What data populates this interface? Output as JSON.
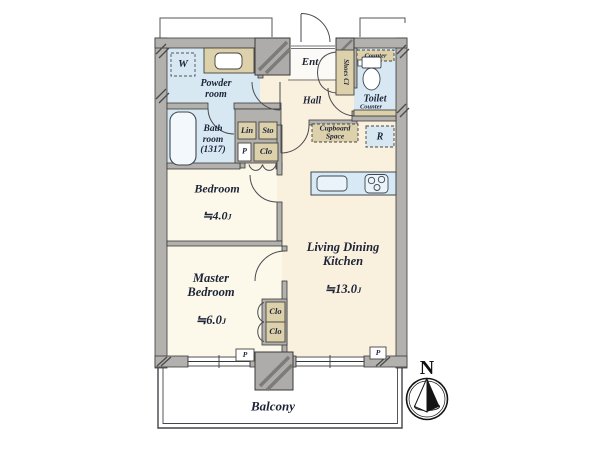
{
  "title": "2LDK apartment floor plan with balcony",
  "colors": {
    "wall_gray": "#b3b1ae",
    "pillar_gray": "#aeacab",
    "wet_room_blue": "#d7e8f3",
    "living_cream": "#faf0de",
    "bedroom_ivory": "#fcf9ea",
    "storage_beige": "#ddd1ac",
    "kitchen_counter_blue": "#d7e9f4",
    "label_text": "#1d2438",
    "outline": "#3a3a3a"
  },
  "rooms": {
    "powder": "Powder\nroom",
    "bath": "Bath\nroom\n(1317)",
    "ent": "Ent",
    "hall": "Hall",
    "toilet": "Toilet",
    "balcony": "Balcony",
    "bedroom": {
      "name": "Bedroom",
      "size": "≒4.0",
      "unit": "J"
    },
    "ldk": {
      "name": "Living Dining\nKitchen",
      "size": "≒13.0",
      "unit": "J"
    },
    "master": {
      "name": "Master\nBedroom",
      "size": "≒6.0",
      "unit": "J"
    }
  },
  "storage": {
    "washer": "W",
    "lin": "Lin",
    "sto": "Sto",
    "p_hall": "P",
    "clo_hall": "Clo",
    "shoes": "Shoes Cl",
    "counter_top": "Counter",
    "counter_side": "Counter",
    "fridge": "R",
    "cupboard": "Cupboard\nSpace",
    "clo_master_1": "Clo",
    "clo_master_2": "Clo",
    "pipe_left": "P",
    "pipe_right": "P"
  },
  "compass": {
    "north": "N"
  }
}
